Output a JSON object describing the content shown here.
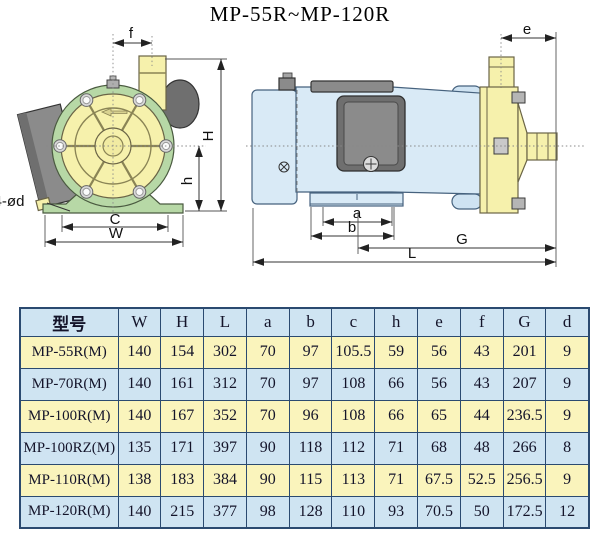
{
  "title": "MP-55R~MP-120R",
  "drawing": {
    "front_view_labels": {
      "f": "f",
      "H": "H",
      "h": "h",
      "C": "C",
      "W": "W",
      "holes": "4-ød"
    },
    "side_view_labels": {
      "e": "e",
      "a": "a",
      "b": "b",
      "G": "G",
      "L": "L"
    }
  },
  "colors": {
    "pump_yellow": "#f6f1ac",
    "casing_green": "#b7d8a6",
    "motor_blue": "#d9eaf6",
    "row_yellow": "#faf4bc",
    "row_blue": "#cfe4f2",
    "table_border": "#2b4a70",
    "metal_gray": "#8b8b8b",
    "dark_gray": "#6f6f6f"
  },
  "table": {
    "headers": [
      "型号",
      "W",
      "H",
      "L",
      "a",
      "b",
      "c",
      "h",
      "e",
      "f",
      "G",
      "d"
    ],
    "rows": [
      {
        "model": "MP-55R(M)",
        "values": [
          "140",
          "154",
          "302",
          "70",
          "97",
          "105.5",
          "59",
          "56",
          "43",
          "201",
          "9"
        ]
      },
      {
        "model": "MP-70R(M)",
        "values": [
          "140",
          "161",
          "312",
          "70",
          "97",
          "108",
          "66",
          "56",
          "43",
          "207",
          "9"
        ]
      },
      {
        "model": "MP-100R(M)",
        "values": [
          "140",
          "167",
          "352",
          "70",
          "96",
          "108",
          "66",
          "65",
          "44",
          "236.5",
          "9"
        ]
      },
      {
        "model": "MP-100RZ(M)",
        "values": [
          "135",
          "171",
          "397",
          "90",
          "118",
          "112",
          "71",
          "68",
          "48",
          "266",
          "8"
        ]
      },
      {
        "model": "MP-110R(M)",
        "values": [
          "138",
          "183",
          "384",
          "90",
          "115",
          "113",
          "71",
          "67.5",
          "52.5",
          "256.5",
          "9"
        ]
      },
      {
        "model": "MP-120R(M)",
        "values": [
          "140",
          "215",
          "377",
          "98",
          "128",
          "110",
          "93",
          "70.5",
          "50",
          "172.5",
          "12"
        ]
      }
    ]
  }
}
